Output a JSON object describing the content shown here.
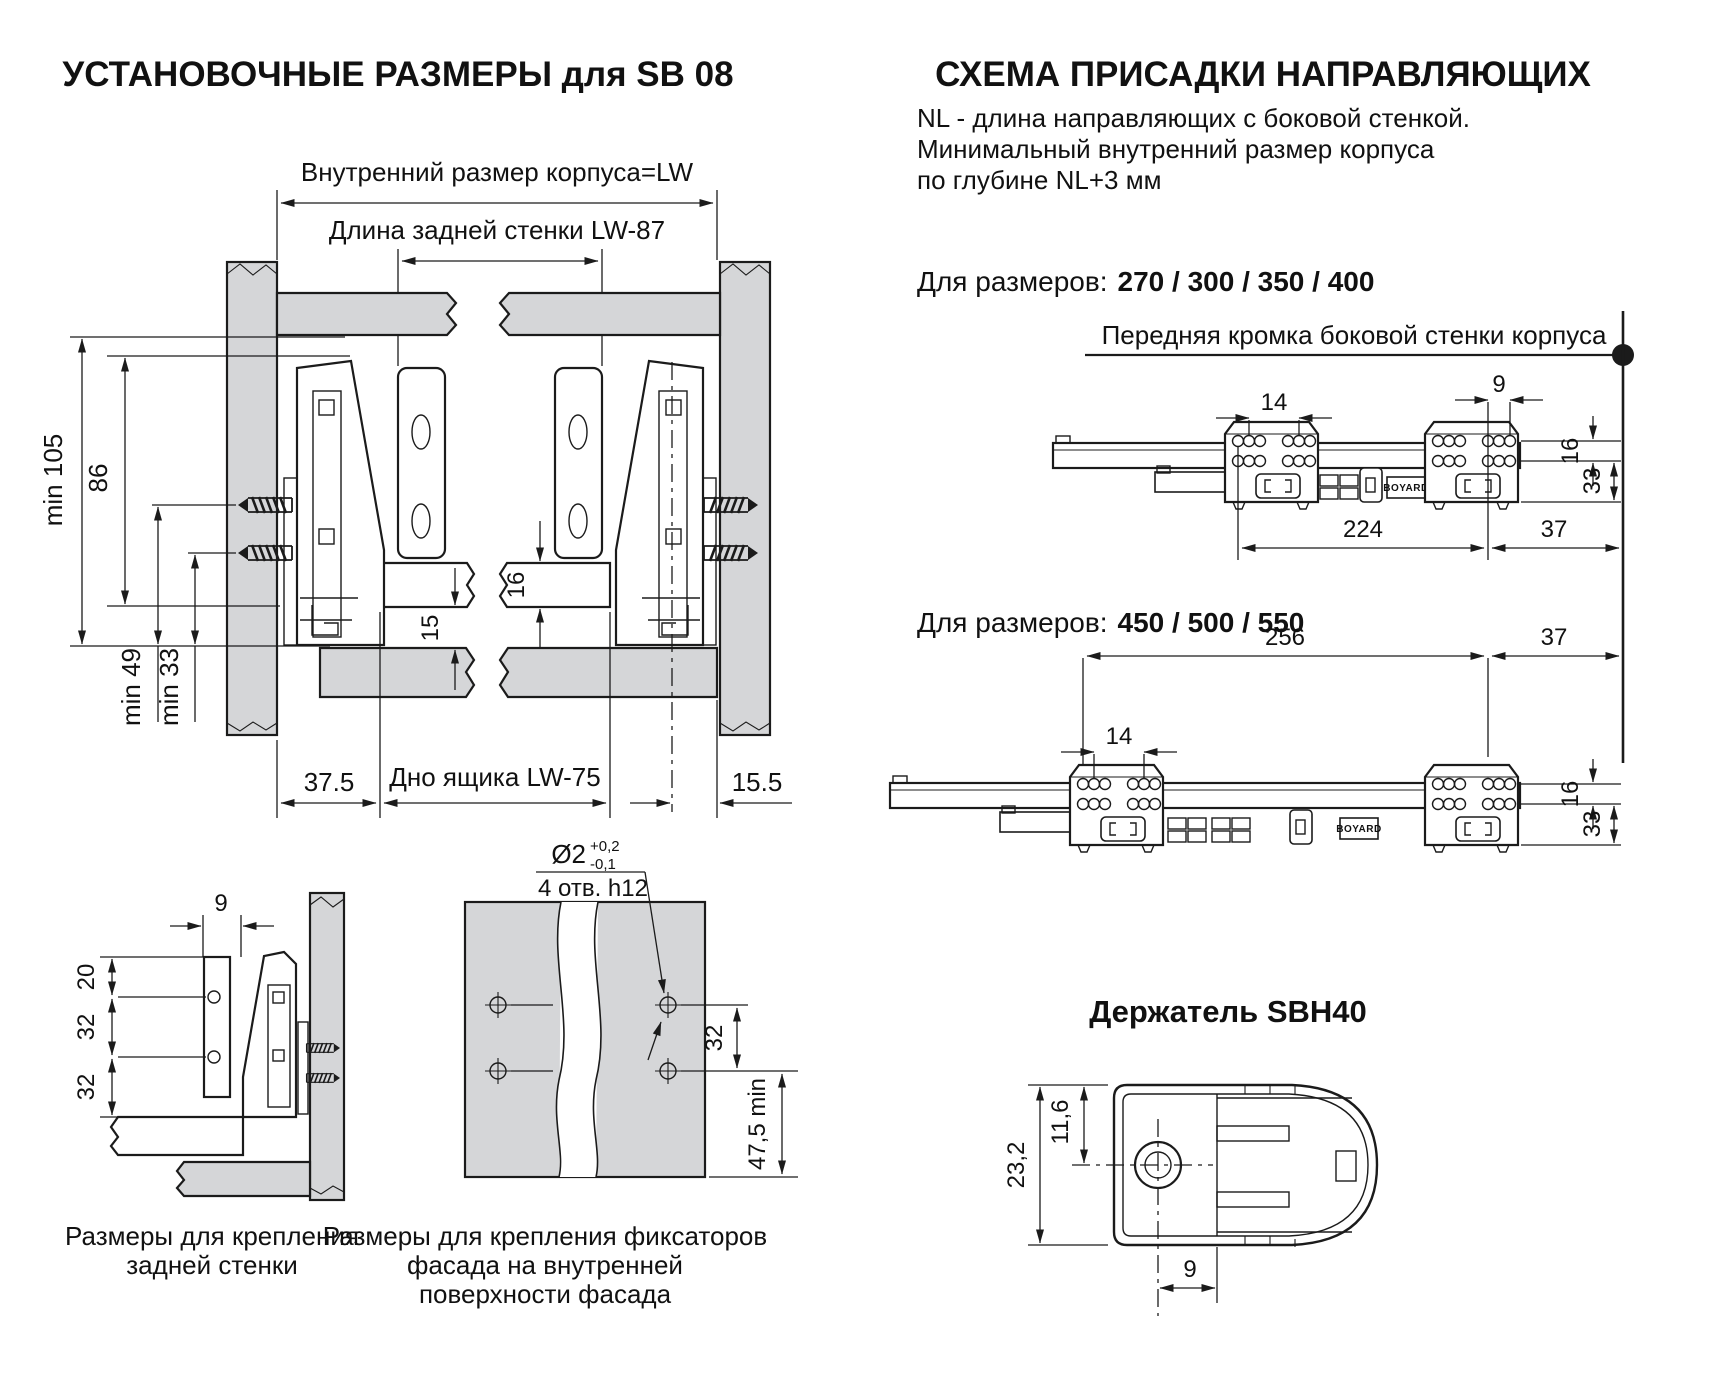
{
  "left": {
    "title": "УСТАНОВОЧНЫЕ РАЗМЕРЫ для SB 08",
    "main": {
      "inner_width_label": "Внутренний размер корпуса=LW",
      "back_wall_label": "Длина задней стенки  LW-87",
      "min105": "min 105",
      "h86": "86",
      "min49": "min 49",
      "min33": "min 33",
      "t15": "15",
      "t16": "16",
      "d375": "37.5",
      "bottom_label": "Дно ящика  LW-75",
      "d155": "15.5"
    },
    "back_fix": {
      "d9": "9",
      "d20": "20",
      "d32a": "32",
      "d32b": "32",
      "caption1": "Размеры  для крепления",
      "caption2": "задней стенки"
    },
    "facade_fix": {
      "dia": "Ø2",
      "tol_up": "+0,2",
      "tol_dn": "-0,1",
      "holes": "4 отв. h12",
      "d32": "32",
      "d475": "47,5 min",
      "caption1": "Размеры для крепления фиксаторов",
      "caption2": "фасада на внутренней",
      "caption3": "поверхности фасада"
    }
  },
  "right": {
    "title": "СХЕМА ПРИСАДКИ НАПРАВЛЯЮЩИХ",
    "note1": "NL - длина направляющих с боковой стенкой.",
    "note2": "Минимальный внутренний размер корпуса",
    "note3": "по глубине NL+3 мм",
    "sizes1_label": "Для размеров:",
    "sizes1_values": "270 / 300 / 350 / 400",
    "sizes2_label": "Для размеров:",
    "sizes2_values": "450 / 500 / 550",
    "front_edge": "Передняя кромка боковой стенки корпуса",
    "rail1": {
      "d14": "14",
      "d9": "9",
      "d16": "16",
      "d33": "33",
      "d224": "224",
      "d37": "37",
      "logo": "BOYARD"
    },
    "rail2": {
      "d14": "14",
      "d16": "16",
      "d33": "33",
      "d256": "256",
      "d37": "37",
      "logo": "BOYARD"
    },
    "holder": {
      "title": "Держатель SBH40",
      "d232": "23,2",
      "d116": "11,6",
      "d9": "9"
    }
  }
}
